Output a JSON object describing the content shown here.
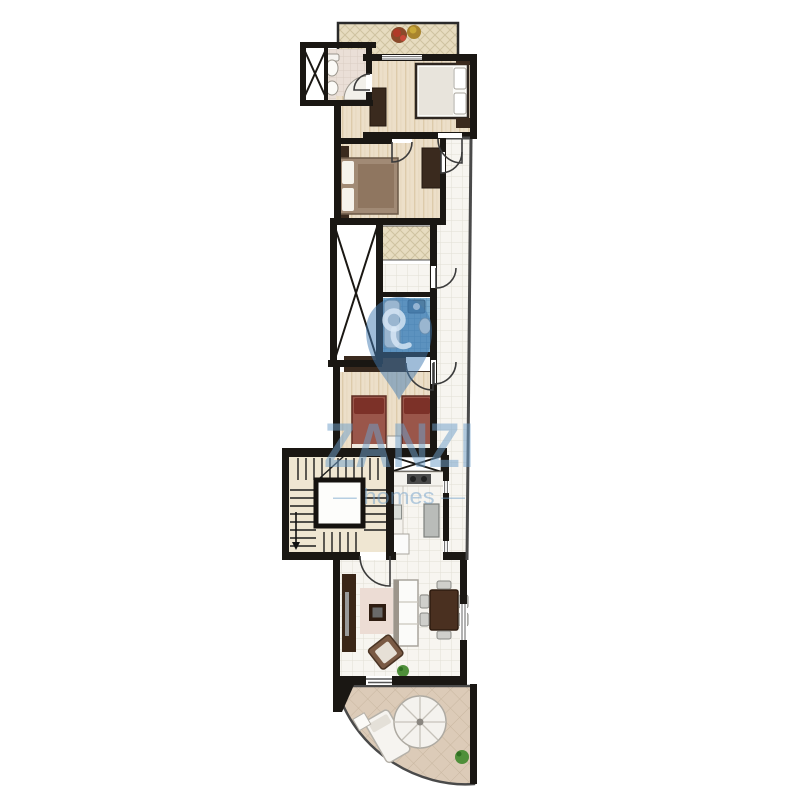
{
  "meta": {
    "type": "floor-plan",
    "view": "top-down apartment plan"
  },
  "watermark": {
    "brand": "ZANZI",
    "tagline": "— homes —",
    "text_color": "#6f9fc9",
    "pin_color": "#3f7ab2",
    "pin_icon": "location-pin-icon"
  },
  "palette": {
    "background": "#ffffff",
    "wall": "#1a1713",
    "wood_floor": "#ecdfc9",
    "wood_grain": "#ddcbab",
    "white_tile": "#f7f5f0",
    "tile_grid": "#e2dfd5",
    "blue_bath_tile": "#79abcd",
    "blue_bath_grid": "#5d92b8",
    "lattice_beige": "#e7dcc0",
    "bath_tile": "#eadfd7",
    "terrace_tile": "#dccbb8",
    "stair_floor": "#efe6d2",
    "dark_furniture": "#3a2a1e",
    "bed_maroon": "#9a564a",
    "pillow_maroon": "#7c3128",
    "bed_linen": "#fbfbf8",
    "rug": "#ecdcd4",
    "plant_green": "#4f8f3a",
    "flower_red": "#b03a28",
    "flower_yellow": "#c8a838"
  }
}
